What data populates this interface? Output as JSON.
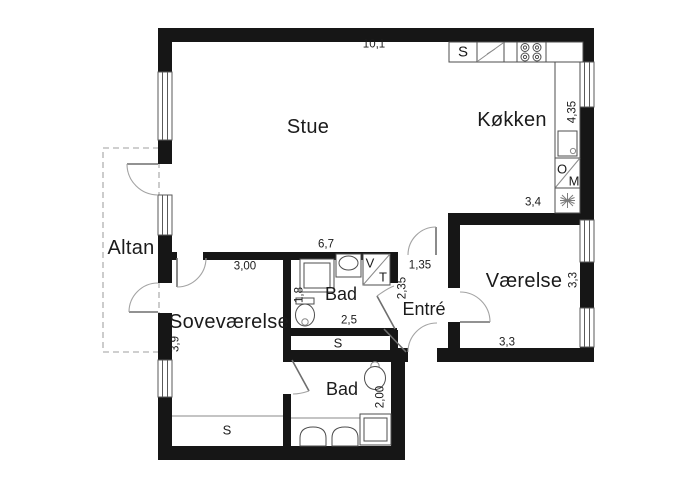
{
  "floorplan": {
    "rooms": {
      "stue": "Stue",
      "kokken": "Køkken",
      "vaerelse": "Værelse",
      "sovevaerelse": "Soveværelse",
      "entre": "Entré",
      "bad_upper": "Bad",
      "bad_lower": "Bad",
      "altan": "Altan"
    },
    "dimensions_m": {
      "overall_top_width": "10,1",
      "kokken_depth": "4,35",
      "kokken_width": "3,4",
      "vaerelse_depth": "3,3",
      "vaerelse_width": "3,3",
      "stue_width": "6,7",
      "sovevaerelse_width": "3,00",
      "sovevaerelse_depth": "3,9",
      "entre_width": "1,35",
      "entre_depth": "2,35",
      "bad_upper_depth": "1,8",
      "bad_upper_width": "2,5",
      "bad_lower_depth": "2,00"
    },
    "appliance_labels": {
      "kitchen_sink": "S",
      "oven": "O",
      "microwave": "M",
      "washer": "V",
      "dryer": "T",
      "closet_hall": "S",
      "closet_bedroom": "S"
    },
    "colors": {
      "wall": "#161616",
      "fixture_line": "#4d4d4d",
      "door_arc": "#9a9a9a",
      "balcony_dash": "#bfbfbf",
      "background": "#ffffff"
    }
  }
}
